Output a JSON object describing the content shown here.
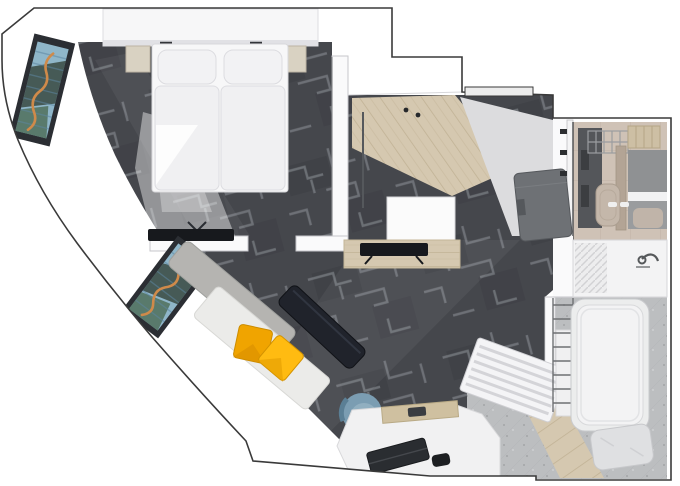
{
  "palette": {
    "outline": "#3a3a3a",
    "wall": "#ffffff",
    "wallSoft": "#fafafb",
    "wallEdge": "#c7c7cb",
    "carpet": "#45474c",
    "carpetLine": "#7d8187",
    "carpetDark": "#3b3d42",
    "wood": "#d5c8b0",
    "woodLine": "#c1b295",
    "lightFloor": "#dcdcde",
    "tan": "#cfc2b6",
    "tanLine": "#c0b3a6",
    "stone": "#bcbec0",
    "stoneDot": "#a9abad",
    "counter": "#f3f3f4",
    "bedding": "#f7f7f8",
    "beddingShade": "#e1e1e5",
    "pillowYellow": "#f0a400",
    "pillowYellow2": "#ffbb11",
    "sofaBack": "#b5b4b1",
    "sofaSeat": "#ebebe9",
    "tableDark": "#20232b",
    "chairBlue": "#7b9db2",
    "chairBlueLight": "#91afc0",
    "wardrobe": "#6e7175",
    "tvBlack": "#17191d",
    "metal": "#6e7073",
    "artBlue": "#8fb6c9",
    "artDark": "#3a4a42",
    "artGreen": "#4b6b55",
    "artOrange": "#cf8a4a",
    "fixtureTan": "#c4b7aa",
    "showerGray": "#8f9193",
    "darkBand": "#54565a",
    "nightstand": "#d9d2c2",
    "radiator": "#f4f4f6"
  },
  "rooms": [
    {
      "name": "bedroom"
    },
    {
      "name": "living-area"
    },
    {
      "name": "entry-hall"
    },
    {
      "name": "bathroom"
    },
    {
      "name": "bathtub-room"
    }
  ],
  "furniture": [
    "headboard-shelf",
    "double-bed",
    "nightstand-left",
    "nightstand-right",
    "bedroom-tv",
    "window-art-1",
    "window-art-2",
    "sofa",
    "yellow-pillow-1",
    "yellow-pillow-2",
    "coffee-table",
    "media-console",
    "console-tv",
    "hall-bench",
    "hall-wardrobe",
    "entry-door",
    "ceiling-lights",
    "desk",
    "desk-chair",
    "laptop",
    "desk-tray",
    "radiator",
    "bathtub",
    "bath-pillow",
    "towel-ladder",
    "sink-counter",
    "sink-faucet",
    "toilet",
    "wire-rack",
    "wood-shelf",
    "shower-panel",
    "door-hinges"
  ]
}
